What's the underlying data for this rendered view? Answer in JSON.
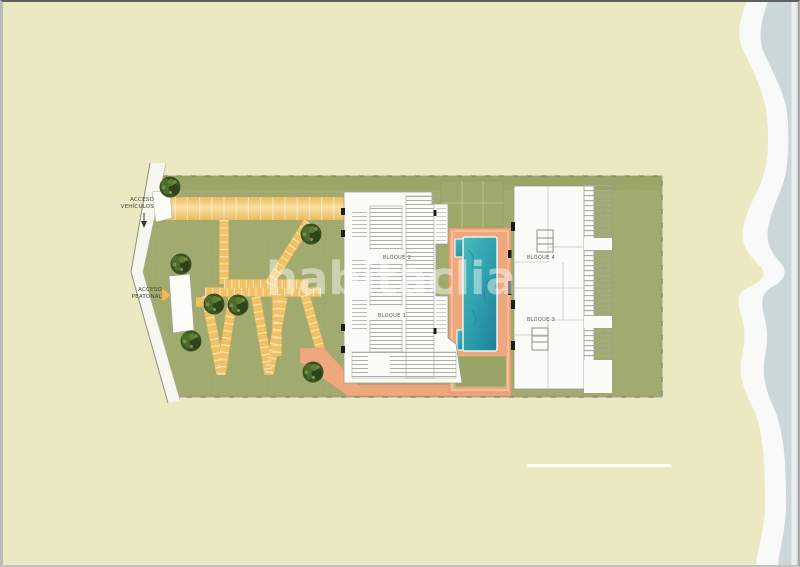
{
  "page": {
    "background_color": "#ece9c2",
    "type": "residential site plan"
  },
  "watermark": {
    "text": "habitaclia"
  },
  "plan": {
    "access_labels": {
      "vehicles": {
        "line1": "ACCESO",
        "line2": "VEHÍCULOS"
      },
      "pedestrian": {
        "line1": "ACCESO",
        "line2": "PEATONAL"
      }
    },
    "blocks": [
      {
        "id": "bloque-2",
        "label": "BLOQUE 2"
      },
      {
        "id": "bloque-1",
        "label": "BLOQUE 1"
      },
      {
        "id": "bloque-4",
        "label": "BLOQUE 4"
      },
      {
        "id": "bloque-3",
        "label": "BLOQUE 3"
      }
    ],
    "icons": {
      "tree": "tree-icon",
      "pedestrian_arrow": "arrow-right-icon",
      "vehicle_arrow": "arrow-down-icon"
    },
    "colors": {
      "sand_background": "#ece9c2",
      "sea": "#ccd7da",
      "surf_white": "#f7faf8",
      "lawn_green": "#a2ab6f",
      "path_yellow": "#f0c265",
      "deck_salmon": "#efa87e",
      "pool_teal": "#2f9fae",
      "building_white": "#fbfbf8",
      "tree_green": "#3a5222",
      "label_text": "#45443b"
    }
  }
}
